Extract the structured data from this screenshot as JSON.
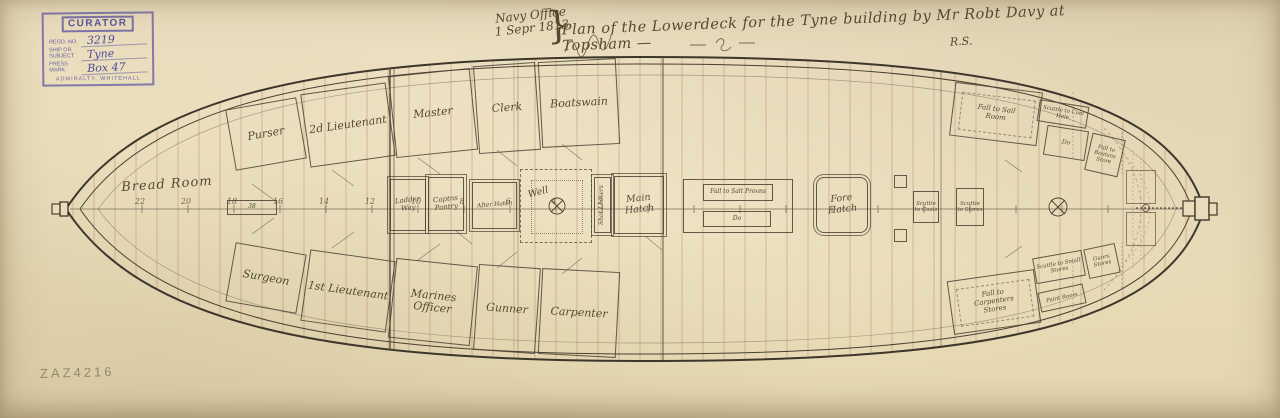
{
  "colors": {
    "paper": "#ebdfc0",
    "ink": "#4a4132",
    "plank_red": "#c08476",
    "stamp_purple": "#6257a5",
    "pencil": "#8d8168"
  },
  "stamp": {
    "title": "CURATOR",
    "fields": [
      {
        "label": "Regd. No.",
        "value": "3219"
      },
      {
        "label": "Ship or Subject",
        "value": "Tyne"
      },
      {
        "label": "Press Mark",
        "value": "Box 47"
      }
    ],
    "footer": "ADMIRALTY, WHITEHALL"
  },
  "title_block": {
    "office": "Navy Office",
    "date": "1 Sepr 1813",
    "brace": "}",
    "main": "Plan of the Lowerdeck for the Tyne building by Mr Robt Davy at Topsham —",
    "initials": "R.S."
  },
  "plan": {
    "bread_room": "Bread Room",
    "cabins_top": [
      {
        "label": "Purser"
      },
      {
        "label": "2d Lieutenant"
      },
      {
        "label": "Master"
      },
      {
        "label": "Clerk"
      },
      {
        "label": "Boatswain"
      }
    ],
    "cabins_bottom": [
      {
        "label": "Surgeon"
      },
      {
        "label": "1st Lieutenant"
      },
      {
        "label": "Marines Officer"
      },
      {
        "label": "Gunner"
      },
      {
        "label": "Carpenter"
      }
    ],
    "compartments": {
      "ladder_way": "Ladder Way",
      "capt_pantry": "Captns Pantry",
      "after_hatch": "After Hatch",
      "well": "Well",
      "shot_lockers": "Shot Lockers",
      "main_hatch": "Main Hatch",
      "fall_salt_provisions": "Fall to Salt Provns",
      "ditto_aft": "Do",
      "fore_hatch": "Fore Hatch",
      "scuttle_to_coals": "Scuttle to Coals",
      "scuttle_to_stores": "Scuttle to Stores",
      "fall_sail_room": "Fall to Sail Room",
      "scuttle_coal_hole": "Scuttle to Coal Hole",
      "ditto_fwd": "Do",
      "fall_boatswains_store": "Fall to Boatsns Store",
      "fall_carpenters_stores": "Fall to Carpenters Stores",
      "scuttle_small_stores": "Scuttle to Small Stores",
      "paint_room": "Paint Room",
      "gunners_stores": "Gunrs Stores",
      "mizzen_station": "38"
    },
    "centerline_numbers": [
      "22",
      "20",
      "18",
      "16",
      "14",
      "12",
      "10",
      "8",
      "6",
      "4",
      "2"
    ]
  },
  "pencil_mark": "ZAZ4216"
}
